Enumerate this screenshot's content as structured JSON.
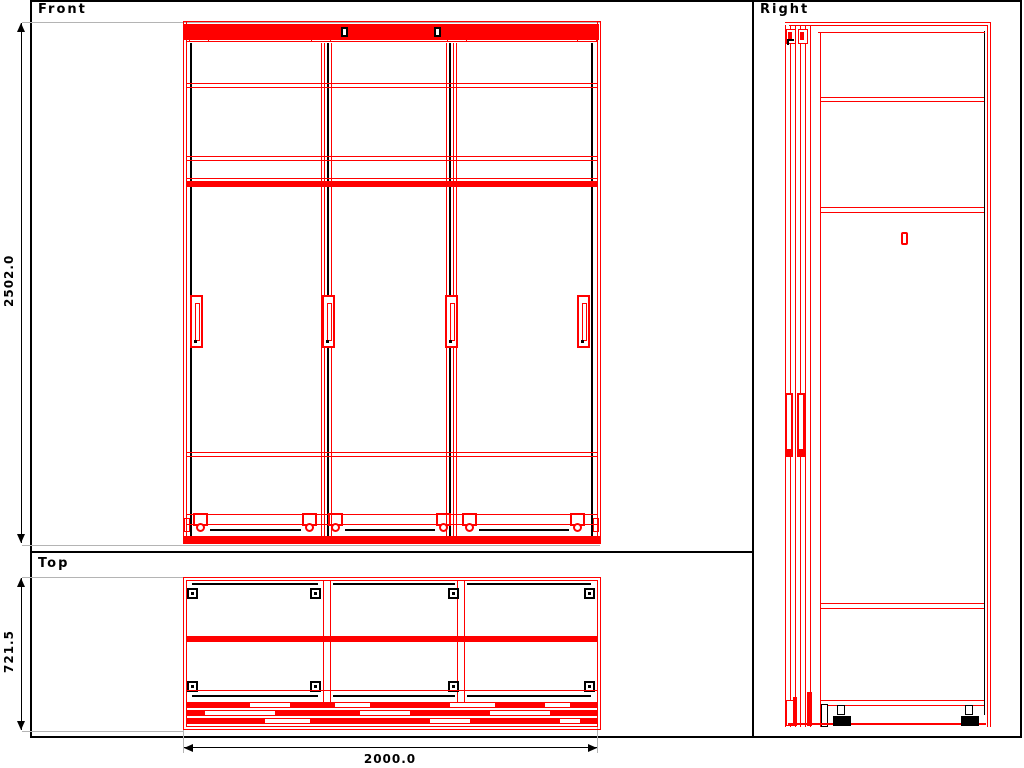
{
  "panels": {
    "front": {
      "label": "Front"
    },
    "top": {
      "label": "Top"
    },
    "right": {
      "label": "Right"
    }
  },
  "dimensions": {
    "height_label": "2502.0",
    "depth_label": "721.5",
    "width_label": "2000.0"
  },
  "drawing": {
    "subject": "three-door sliding wardrobe",
    "views": [
      "Front",
      "Top",
      "Right"
    ]
  },
  "colors": {
    "drawing": "#ff0000",
    "frame": "#000000",
    "extension": "#b4b4b4",
    "background": "#ffffff"
  }
}
